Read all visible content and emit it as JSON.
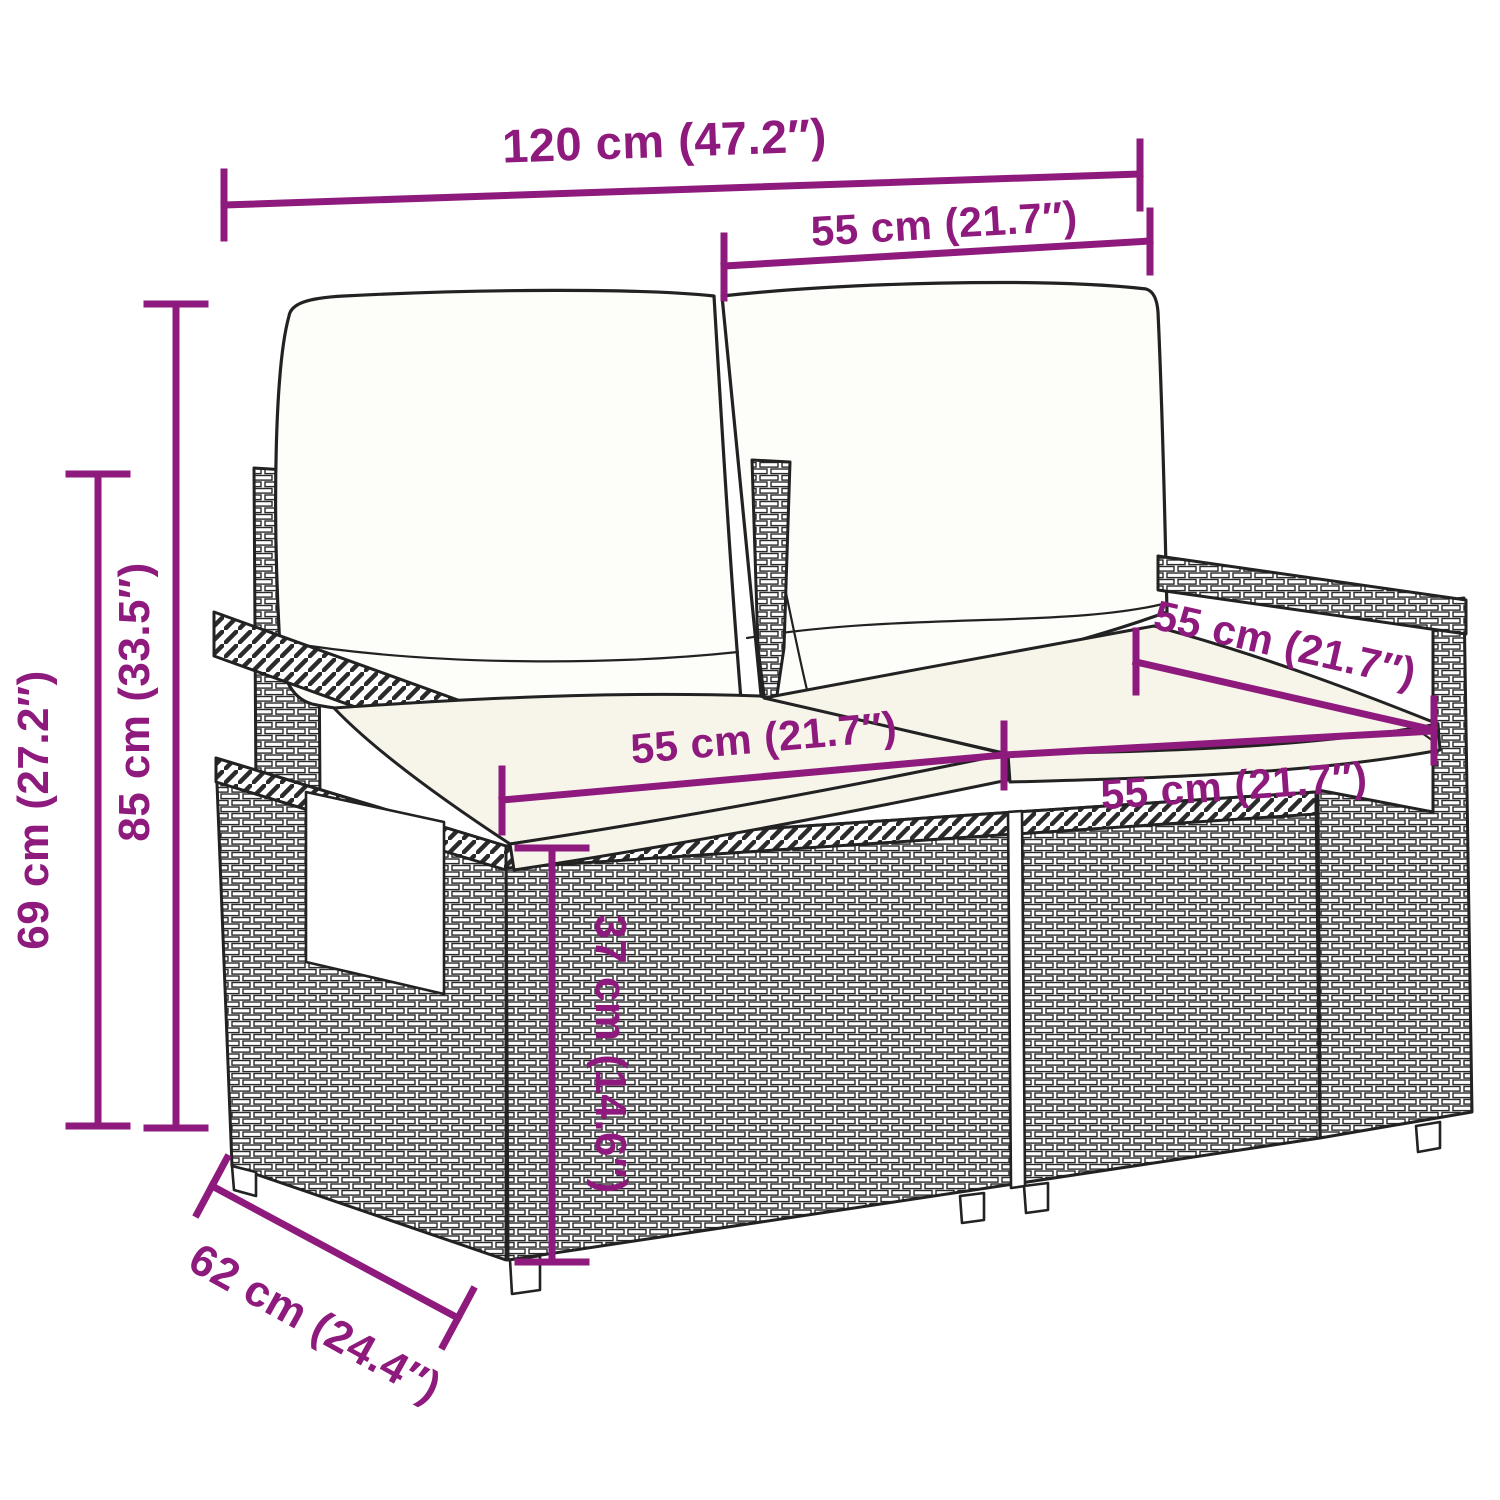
{
  "colors": {
    "background": "#ffffff",
    "dimension_accent": "#8e1a7d",
    "line_art": "#222222",
    "seat_cushion_fill": "#f7f4ea",
    "back_cushion_fill": "#fdfdfa"
  },
  "diagram": {
    "type": "product-dimension-diagram",
    "subject": "Poly rattan 2-seater garden sofa with back and seat cushions",
    "dimensions": {
      "total_width": {
        "label": "120 cm (47.2″)",
        "cm": 120,
        "inches": 47.2
      },
      "back_section_width": {
        "label": "55 cm (21.7″)",
        "cm": 55,
        "inches": 21.7
      },
      "total_height": {
        "label": "85 cm (33.5″)",
        "cm": 85,
        "inches": 33.5
      },
      "armrest_height": {
        "label": "69 cm (27.2″)",
        "cm": 69,
        "inches": 27.2
      },
      "seat_width_left": {
        "label": "55 cm (21.7″)",
        "cm": 55,
        "inches": 21.7
      },
      "seat_depth": {
        "label": "55 cm (21.7″)",
        "cm": 55,
        "inches": 21.7
      },
      "seat_width_right": {
        "label": "55 cm (21.7″)",
        "cm": 55,
        "inches": 21.7
      },
      "seat_height": {
        "label": "37 cm (14.6″)",
        "cm": 37,
        "inches": 14.6
      },
      "total_depth": {
        "label": "62 cm (24.4″)",
        "cm": 62,
        "inches": 24.4
      }
    }
  }
}
